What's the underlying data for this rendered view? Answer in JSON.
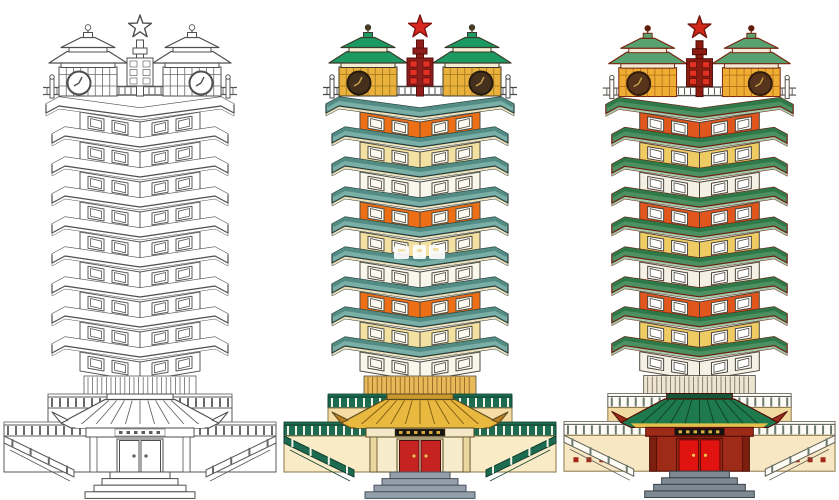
{
  "scene": {
    "background": "#FFFFFF",
    "subject": "twin-pagoda memorial clock tower illustration",
    "variant_count": 3
  },
  "structure": {
    "floors": 9,
    "floor_color_cycle": [
      "orange",
      "cream",
      "white"
    ],
    "clock_turrets": 2,
    "star_finial": true,
    "entrance": {
      "double_doors": true,
      "step_count": 4,
      "plaque_text_legible": false
    }
  },
  "watermark": {
    "present_on": "tower-colored-warm",
    "legible": false,
    "color": "#FFFFFF"
  },
  "towers": [
    {
      "id": "tower-line-art",
      "label": "line art variant",
      "watermark": false,
      "palette": {
        "outline": "#4F4F4F",
        "eaveFace": "#FFFFFF",
        "eaveTop": "#FFFFFF",
        "eaveUnder": "#FFFFFF",
        "eaveStroke": "#4F4F4F",
        "wallStroke": "#5A5A5A",
        "floors": [
          "#FFFFFF",
          "#FFFFFF",
          "#FFFFFF"
        ],
        "window": "#FFFFFF",
        "windowStroke": "#5A5A5A",
        "turretRoof": "#FFFFFF",
        "turretBand": "#FFFFFF",
        "turretWall": "#FFFFFF",
        "turretGrid": "#6A6A6A",
        "turretStroke": "#4F4F4F",
        "finial": "#FFFFFF",
        "clockFace": "#FFFFFF",
        "clockRim": "#4F4F4F",
        "clockHands": "#4F4F4F",
        "pole": "#FFFFFF",
        "poleBlock": "#FFFFFF",
        "poleStroke": "#4F4F4F",
        "star": "#FFFFFF",
        "starStroke": "#4F4F4F",
        "railFill": "#FFFFFF",
        "railStroke": "#5A5A5A",
        "skirtFill": "#FFFFFF",
        "skirtLine": "#6A6A6A",
        "balFill": "#FFFFFF",
        "balPost": "#6A6A6A",
        "balStroke": "#5A5A5A",
        "baseWall": "#FFFFFF",
        "baseWall2": "#FFFFFF",
        "baseStroke": "#5A5A5A",
        "entRidge": "#FFFFFF",
        "entRoof": "#FFFFFF",
        "entRoofRib": "#6A6A6A",
        "entCorner": "#FFFFFF",
        "entTrim": "#FFFFFF",
        "entFrieze": "#FFFFFF",
        "entWall": "#FFFFFF",
        "entPillar": "#FFFFFF",
        "entStroke": "#4F4F4F",
        "plaque": "#FFFFFF",
        "plaqueText": "#5A5A5A",
        "door": "#FFFFFF",
        "doorStroke": "#4F4F4F",
        "handle": "#5A5A5A",
        "steps": "#FFFFFF",
        "stepsStroke": "#4F4F4F",
        "baseDots": null
      }
    },
    {
      "id": "tower-colored-warm",
      "label": "warm colored variant",
      "watermark": true,
      "palette": {
        "outline": "#3A4743",
        "eaveFace": "#79AFA6",
        "eaveTop": "#528C84",
        "eaveUnder": "#EFE2BE",
        "eaveStroke": "#263B38",
        "wallStroke": "#4E4B40",
        "floors": [
          "#ED6F15",
          "#F3E1A2",
          "#F9F6EC"
        ],
        "window": "#FCFAF0",
        "windowStroke": "#4E4B40",
        "turretRoof": "#1D9A61",
        "turretBand": "#F5EDD2",
        "turretWall": "#EBB13D",
        "turretGrid": "#99741F",
        "turretStroke": "#3C3A2A",
        "finial": "#4A3A20",
        "clockFace": "#45301E",
        "clockRim": "#271A0E",
        "clockHands": "#C9A24B",
        "pole": "#8E1D1B",
        "poleBlock": "#E13122",
        "poleStroke": "#57100F",
        "star": "#D7281D",
        "starStroke": "#7C1310",
        "railFill": "#FFFFFF",
        "railStroke": "#474747",
        "skirtFill": "#E7B95B",
        "skirtLine": "#8A5F18",
        "balFill": "#1D6B50",
        "balPost": "#F5F2E6",
        "balStroke": "#123F30",
        "baseWall": "#F6DCA3",
        "baseWall2": "#FAEBC7",
        "baseStroke": "#8A7748",
        "entRidge": "#C9982E",
        "entRoof": "#E9B83E",
        "entRoofRib": "#7C5A12",
        "entCorner": "#B97B20",
        "entTrim": "#E9B83E",
        "entFrieze": "#F3E8C8",
        "entWall": "#F6ECCB",
        "entPillar": "#EAD7A0",
        "entStroke": "#5C4A20",
        "plaque": "#171512",
        "plaqueText": "#D9A92F",
        "door": "#C52321",
        "doorStroke": "#4E0F0E",
        "handle": "#E8C050",
        "steps": "#93A0AB",
        "stepsStroke": "#49525B",
        "baseDots": null
      }
    },
    {
      "id": "tower-colored-deep",
      "label": "deep colored variant",
      "watermark": false,
      "palette": {
        "outline": "#6D1F12",
        "eaveFace": "#4D9162",
        "eaveTop": "#2F7847",
        "eaveUnder": "#A3CCAD",
        "eaveStroke": "#6D1F12",
        "wallStroke": "#4A443A",
        "floors": [
          "#E1561C",
          "#EFCB63",
          "#F4F0E3"
        ],
        "window": "#FFFFFF",
        "windowStroke": "#4A443A",
        "turretRoof": "#58A271",
        "turretBand": "#F2E9D3",
        "turretWall": "#EFAE33",
        "turretGrid": "#B06B1B",
        "turretStroke": "#76240F",
        "finial": "#5A1F10",
        "clockFace": "#57341C",
        "clockRim": "#321C0C",
        "clockHands": "#C9A24B",
        "pole": "#8C1C10",
        "poleBlock": "#E13122",
        "poleStroke": "#4E0D06",
        "star": "#D2291A",
        "starStroke": "#6E150B",
        "railFill": "#FFFFFF",
        "railStroke": "#55514A",
        "skirtFill": "#EDE5D0",
        "skirtLine": "#6B675C",
        "balFill": "#FDFBF4",
        "balPost": "#6A7A6E",
        "balStroke": "#5B5B52",
        "baseWall": "#F2D9A0",
        "baseWall2": "#F7E8C3",
        "baseStroke": "#8A7748",
        "entRidge": "#13563A",
        "entRoof": "#1E7A4C",
        "entRoofRib": "#0C3F26",
        "entCorner": "#9B2A19",
        "entTrim": "#E5C04D",
        "entFrieze": "#9E2A18",
        "entWall": "#9E2A18",
        "entPillar": "#7C1F0E",
        "entStroke": "#4E0D06",
        "plaque": "#151310",
        "plaqueText": "#E0B041",
        "door": "#E01311",
        "doorStroke": "#5E0B07",
        "handle": "#E8C050",
        "steps": "#7E8A93",
        "stepsStroke": "#39424A",
        "baseDots": "#A02818"
      }
    }
  ]
}
